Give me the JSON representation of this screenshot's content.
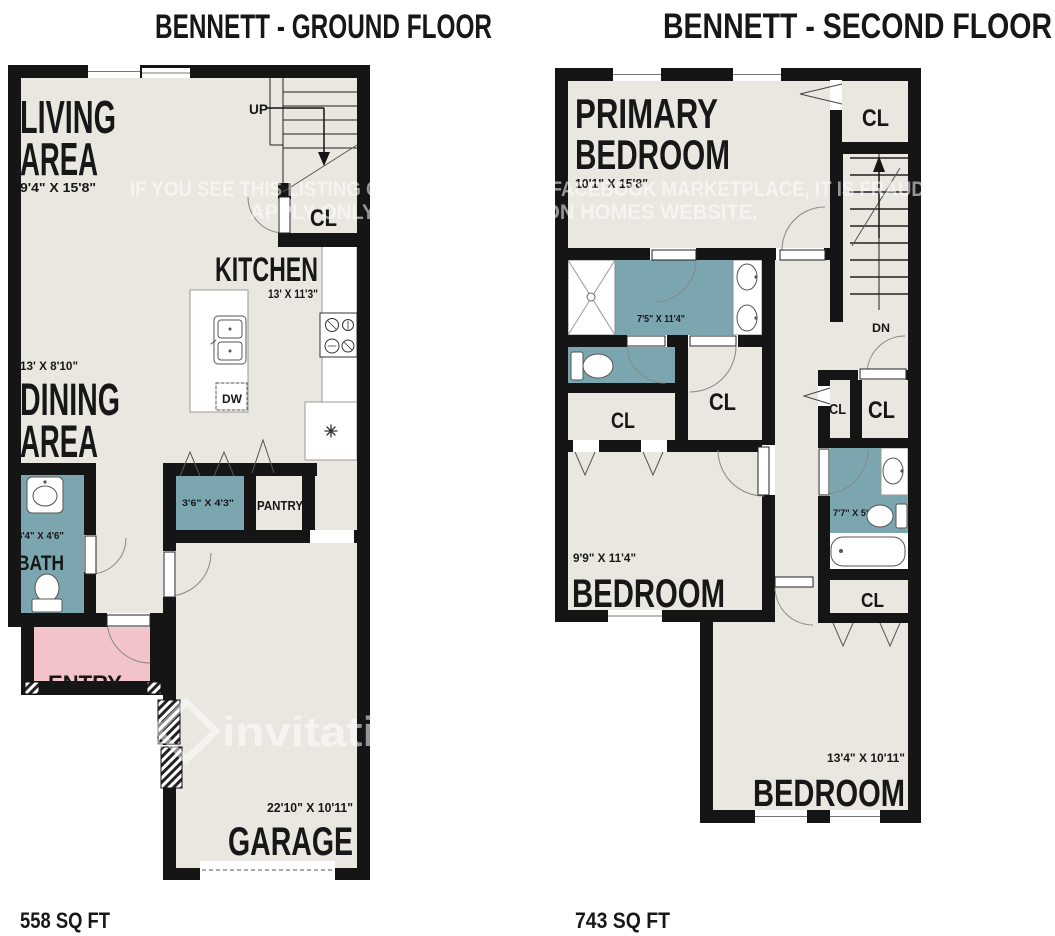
{
  "colors": {
    "wall": "#151515",
    "floor": "#e9e7e0",
    "wet_room_teal": "#7ba6b0",
    "entry_pink": "#f2c4c9",
    "watermark": "#ffffff"
  },
  "ground_floor": {
    "title": "BENNETT - GROUND FLOOR",
    "area": "558 SQ FT",
    "living": {
      "line1": "LIVING",
      "line2": "AREA",
      "dims": "9'4\" X 15'8\""
    },
    "kitchen": {
      "name": "KITCHEN",
      "dims": "13' X 11'3\""
    },
    "dining": {
      "line1": "DINING",
      "line2": "AREA",
      "dims": "13' X 8'10\""
    },
    "bath": {
      "name": "BATH",
      "dims": "8'4\" X 4'6\""
    },
    "closet_dims": "3'6\" X 4'3\"",
    "pantry": "PANTRY",
    "entry": "ENTRY",
    "garage": {
      "name": "GARAGE",
      "dims": "22'10\" X 10'11\""
    },
    "closet": "CL",
    "up": "UP",
    "dishwasher": "DW"
  },
  "second_floor": {
    "title": "BENNETT - SECOND FLOOR",
    "area": "743 SQ FT",
    "primary": {
      "line1": "PRIMARY",
      "line2": "BEDROOM",
      "dims": "10'1\" X 15'8\""
    },
    "primary_bath_dims": "7'5\" X 11'4\"",
    "bedroom2": {
      "name": "BEDROOM",
      "dims": "9'9\" X 11'4\""
    },
    "bedroom3": {
      "name": "BEDROOM",
      "dims": "13'4\" X 10'11\""
    },
    "bath2_dims": "7'7\" X 5'",
    "down": "DN",
    "closet": "CL"
  },
  "watermark": {
    "line1": "IF YOU SEE THIS LISTING ON CRAIGSLIST OR FACEBOOK MARKETPLACE, IT IS FRAUD,",
    "line2": "APPLY ONLY ON THE INVITATION HOMES WEBSITE.",
    "brand": "invitation"
  }
}
